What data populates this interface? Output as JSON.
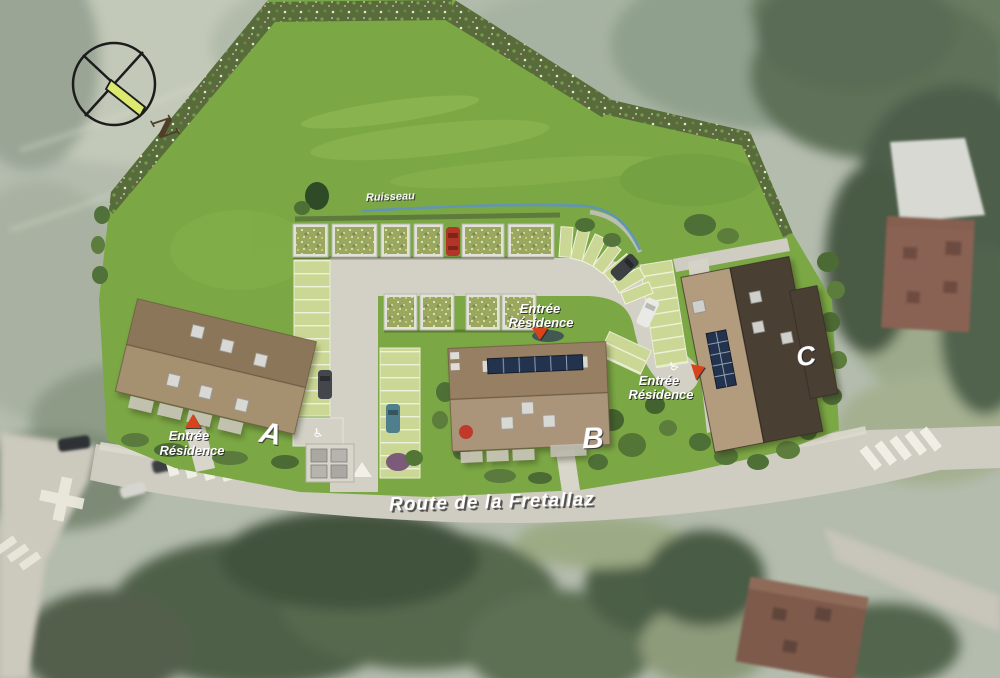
{
  "compass": {
    "north_label": "N"
  },
  "labels": {
    "stream": "Ruisseau",
    "road": "Route de la Fretallaz"
  },
  "entrances": [
    {
      "line1": "Entrée",
      "line2": "Résidence"
    },
    {
      "line1": "Entrée",
      "line2": "Résidence"
    },
    {
      "line1": "Entrée",
      "line2": "Résidence"
    }
  ],
  "buildings": [
    {
      "label": "A"
    },
    {
      "label": "B"
    },
    {
      "label": "C"
    }
  ],
  "icons": {
    "handicap": "♿"
  },
  "colors": {
    "lawn": "#7ba844",
    "meadow_border": "#566a3b",
    "roof_light": "#a59070",
    "roof_dark": "#8c7659",
    "roof_c_dark": "#4a3f33",
    "driveway": "#d3d0c6",
    "stream": "#5f93bb",
    "entrance_marker": "#d8431c",
    "compass_arrow": "#dce96e",
    "solar_panel": "#23334d"
  }
}
